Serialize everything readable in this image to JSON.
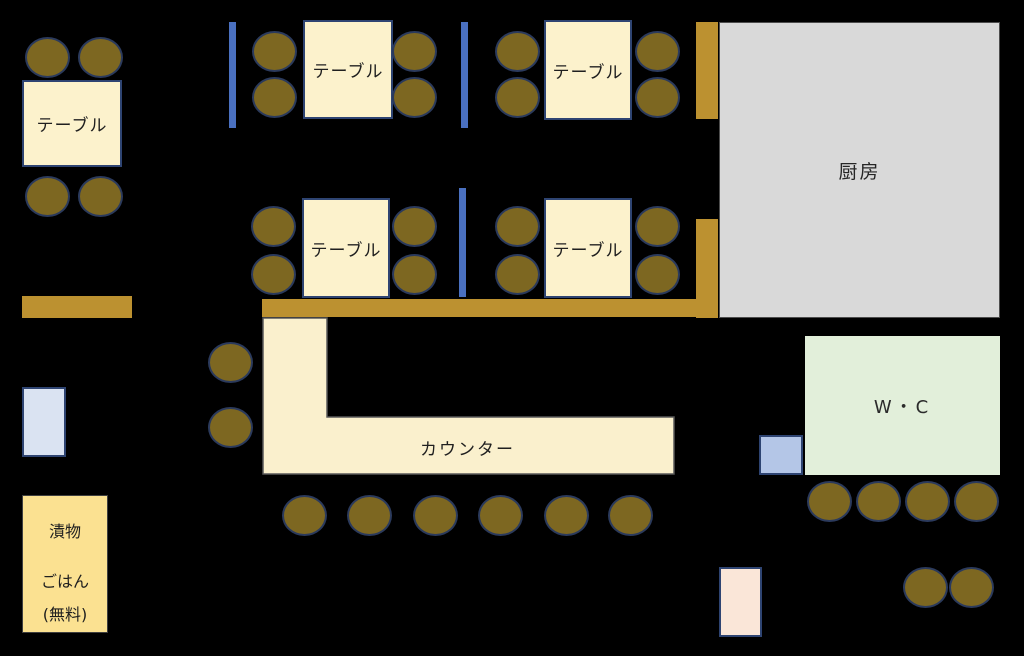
{
  "labels": {
    "table": "テーブル",
    "kitchen": "厨房",
    "counter": "カウンター",
    "wc": "W・C",
    "pickles": "漬物",
    "rice": "ごはん",
    "free": "(無料)"
  },
  "colors": {
    "background": "#000000",
    "table_fill": "#fcf2cc",
    "table_border": "#2e4472",
    "chair_fill": "#7d6721",
    "chair_border": "#2b3a5c",
    "partition_blue": "#4a70c0",
    "wall_gold": "#bc9130",
    "kitchen_fill": "#d9d9d9",
    "kitchen_border": "#4d4d4d",
    "counter_fill": "#faf0cd",
    "wc_fill": "#e2efda",
    "door_left_fill": "#dae3f2",
    "door_wc_fill": "#b4c6e7",
    "door_bottom_fill": "#fae6d8",
    "pickle_box_fill": "#fbe191"
  },
  "counts": {
    "tables": 5,
    "chairs": 34,
    "partitions": 3,
    "door_markers": 3
  }
}
